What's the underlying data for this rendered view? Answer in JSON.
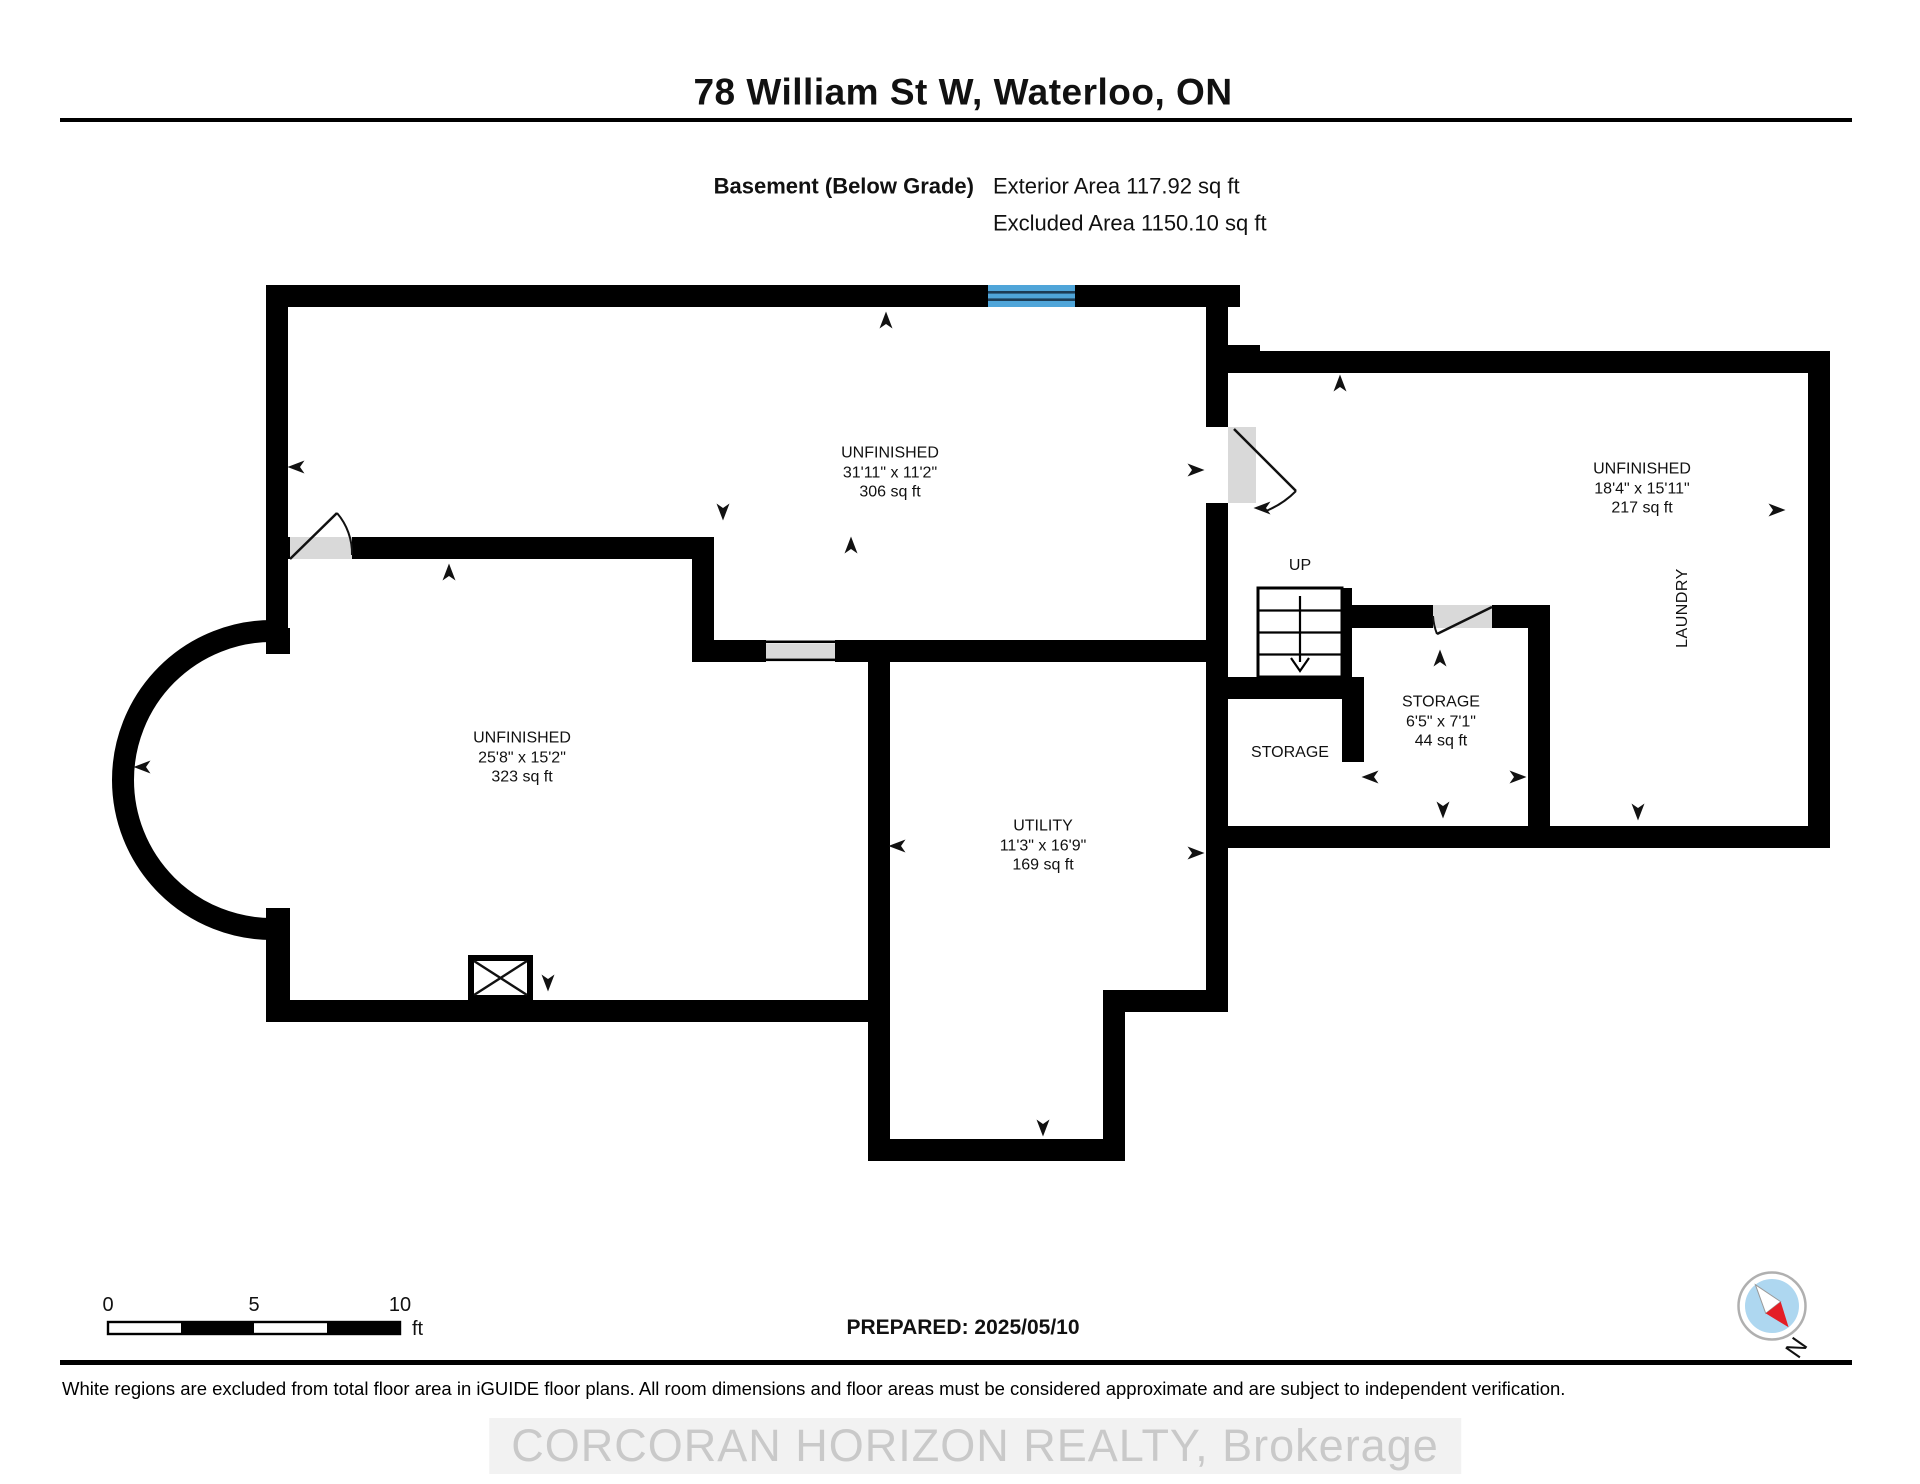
{
  "header": {
    "title": "78 William St W, Waterloo, ON",
    "floor_label": "Basement (Below Grade)",
    "exterior_area": "Exterior Area 117.92 sq ft",
    "excluded_area": "Excluded Area 1150.10 sq ft"
  },
  "rooms": {
    "top": {
      "name": "UNFINISHED",
      "dims": "31'11\" x 11'2\"",
      "area": "306 sq ft"
    },
    "right": {
      "name": "UNFINISHED",
      "dims": "18'4\" x 15'11\"",
      "area": "217 sq ft"
    },
    "left": {
      "name": "UNFINISHED",
      "dims": "25'8\" x 15'2\"",
      "area": "323 sq ft"
    },
    "utility": {
      "name": "UTILITY",
      "dims": "11'3\" x 16'9\"",
      "area": "169 sq ft"
    },
    "storage_small": {
      "name": "STORAGE",
      "dims": "6'5\" x 7'1\"",
      "area": "44 sq ft"
    },
    "storage_left_label": "STORAGE",
    "laundry_label": "LAUNDRY",
    "stairs_label": "UP"
  },
  "scale_bar": {
    "tick0": "0",
    "tick5": "5",
    "tick10": "10",
    "unit": "ft"
  },
  "prepared": "PREPARED: 2025/05/10",
  "compass": {
    "north_label": "N"
  },
  "footer": {
    "disclaimer": "White regions are excluded from total floor area in iGUIDE floor plans. All room dimensions and floor areas must be considered approximate and are subject to independent verification.",
    "watermark": "CORCORAN HORIZON REALTY, Brokerage"
  },
  "colors": {
    "wall": "#000000",
    "window_blue": "#4fa5d9",
    "window_line": "#1c3c55",
    "door_gray": "#d9d9d9",
    "compass_inner": "#aed7f0",
    "compass_red": "#e41e26",
    "watermark": "#c9c9c9"
  }
}
